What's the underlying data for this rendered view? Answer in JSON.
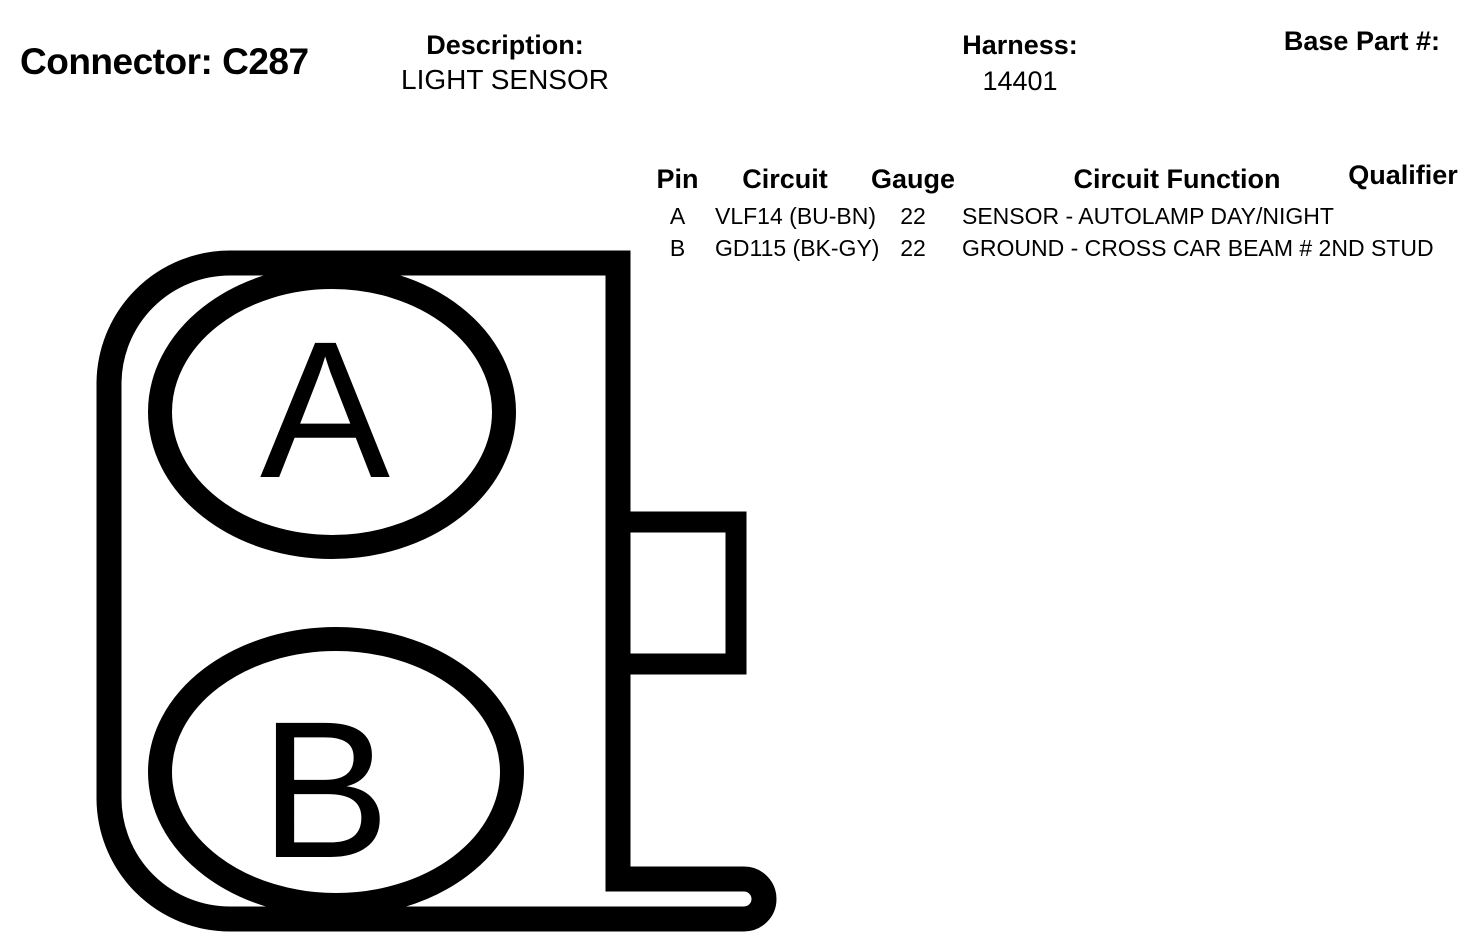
{
  "header": {
    "connector_label": "Connector: C287",
    "description_label": "Description:",
    "description_value": "LIGHT SENSOR",
    "harness_label": "Harness:",
    "harness_value": "14401",
    "base_part_label": "Base Part #:"
  },
  "table": {
    "columns": [
      "Pin",
      "Circuit",
      "Gauge",
      "Circuit Function",
      "Qualifier"
    ],
    "rows": [
      {
        "pin": "A",
        "circuit": "VLF14 (BU-BN)",
        "gauge": "22",
        "function": "SENSOR - AUTOLAMP DAY/NIGHT",
        "qualifier": ""
      },
      {
        "pin": "B",
        "circuit": "GD115 (BK-GY)",
        "gauge": "22",
        "function": "GROUND - CROSS CAR BEAM # 2ND STUD",
        "qualifier": ""
      }
    ]
  },
  "diagram": {
    "pins": [
      "A",
      "B"
    ],
    "line_color": "#000000",
    "background_color": "#ffffff"
  }
}
